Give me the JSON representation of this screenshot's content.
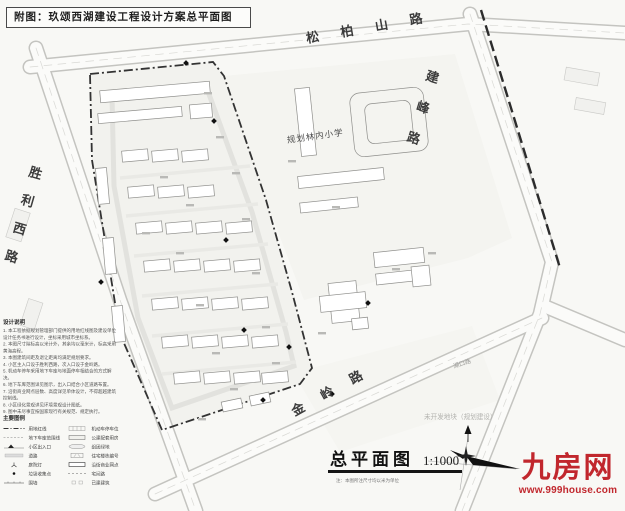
{
  "title_block": {
    "text": "附图：玖颂西湖建设工程设计方案总平面图"
  },
  "roads": {
    "north": "松柏山路",
    "east": "建峰路",
    "west": "胜利西路",
    "south": "金岭路",
    "southeast": "湖口路"
  },
  "site_labels": {
    "school": "规划林内小学",
    "undeveloped": "未开发地块（规划建设）"
  },
  "plan_title": {
    "name": "总平面图",
    "scale": "1:1000",
    "note": "注：本图所注尺寸均以米为单位"
  },
  "notes": {
    "title": "设计说明",
    "items": [
      "1. 本工程依据规划管理部门提供的用地红线图及建设单位设计任务书进行设计，坐标采用城市坐标系。",
      "2. 本图尺寸除标高以米计外，其余均以毫米计，标高采用黄海高程。",
      "3. 本图建筑间距及退让距离均满足规划要求。",
      "4. 小区主入口设于胜利西路，次入口设于金岭路。",
      "5. 机动车停车采用地下车库与地面停车相结合的方式解决。",
      "6. 地下车库范围详见图示，出入口结合小区道路布置。",
      "7. 沿街商业网点层数、高度详见单体设计，不得超越建筑控制线。",
      "8. 小区绿化景观详见环境景观设计图纸。",
      "9. 图中未尽事宜按国家现行有关规范、规定执行。"
    ]
  },
  "legend": {
    "title": "主要图例",
    "left": [
      {
        "label": "用地红线"
      },
      {
        "label": "地下车库范围线"
      },
      {
        "label": "小区出入口"
      },
      {
        "label": "道路"
      },
      {
        "label": "庭院灯"
      },
      {
        "label": "垃圾收集点"
      },
      {
        "label": "围墙"
      }
    ],
    "right": [
      {
        "label": "机动车停车位"
      },
      {
        "label": "公建配套用房"
      },
      {
        "label": "组团绿地"
      },
      {
        "label": "住宅楼栋编号"
      },
      {
        "label": "沿街商业网点"
      },
      {
        "label": "宅间路"
      },
      {
        "label": "已建建筑"
      }
    ]
  },
  "watermark": {
    "brand": "九房网",
    "site": "www.999house.com"
  },
  "colors": {
    "watermark_red": "#c1272d",
    "boundary": "#333333"
  }
}
